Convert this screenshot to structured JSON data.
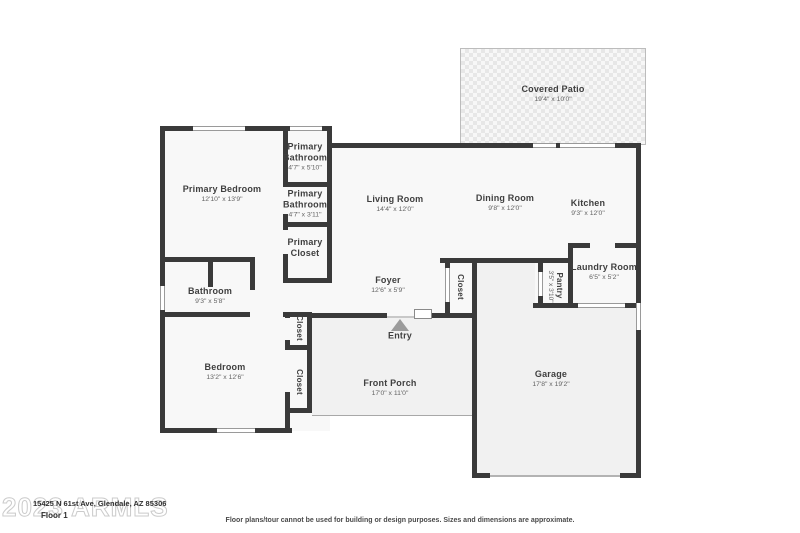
{
  "floor_plan": {
    "watermark": "2023 ARMLS",
    "address": "15425 N 61st Ave, Glendale, AZ 85306",
    "floor_label": "Floor 1",
    "disclaimer": "Floor plans/tour cannot be used for building or design purposes. Sizes and dimensions are approximate.",
    "colors": {
      "wall": "#3a3a3a",
      "room_fill": "#f8f8f8",
      "slab_fill": "#f1f1f1",
      "label": "#3f3f3f",
      "dimension": "#636363"
    },
    "rooms": [
      {
        "id": "covered-patio",
        "name": "Covered Patio",
        "dims": "19'4\" x 10'0\""
      },
      {
        "id": "primary-bedroom",
        "name": "Primary Bedroom",
        "dims": "12'10\" x 13'9\""
      },
      {
        "id": "primary-bathroom-1",
        "name": "Primary Bathroom",
        "dims": "4'7\" x 5'10\""
      },
      {
        "id": "primary-bathroom-2",
        "name": "Primary Bathroom",
        "dims": "4'7\" x 3'11\""
      },
      {
        "id": "primary-closet",
        "name": "Primary Closet",
        "dims": ""
      },
      {
        "id": "living-room",
        "name": "Living Room",
        "dims": "14'4\" x 12'0\""
      },
      {
        "id": "dining-room",
        "name": "Dining Room",
        "dims": "9'8\" x 12'0\""
      },
      {
        "id": "kitchen",
        "name": "Kitchen",
        "dims": "9'3\" x 12'0\""
      },
      {
        "id": "laundry-room",
        "name": "Laundry Room",
        "dims": "6'5\" x 5'2\""
      },
      {
        "id": "pantry",
        "name": "Pantry",
        "dims": "3'5\" x 3'10\""
      },
      {
        "id": "foyer",
        "name": "Foyer",
        "dims": "12'6\" x 5'9\""
      },
      {
        "id": "closet-foyer",
        "name": "Closet",
        "dims": ""
      },
      {
        "id": "bathroom",
        "name": "Bathroom",
        "dims": "9'3\" x 5'8\""
      },
      {
        "id": "bedroom",
        "name": "Bedroom",
        "dims": "13'2\" x 12'6\""
      },
      {
        "id": "closet-hall",
        "name": "Closet",
        "dims": ""
      },
      {
        "id": "closet-bedroom",
        "name": "Closet",
        "dims": ""
      },
      {
        "id": "front-porch",
        "name": "Front Porch",
        "dims": "17'0\" x 11'0\""
      },
      {
        "id": "garage",
        "name": "Garage",
        "dims": "17'8\" x 19'2\""
      },
      {
        "id": "entry",
        "name": "Entry",
        "dims": ""
      }
    ]
  }
}
